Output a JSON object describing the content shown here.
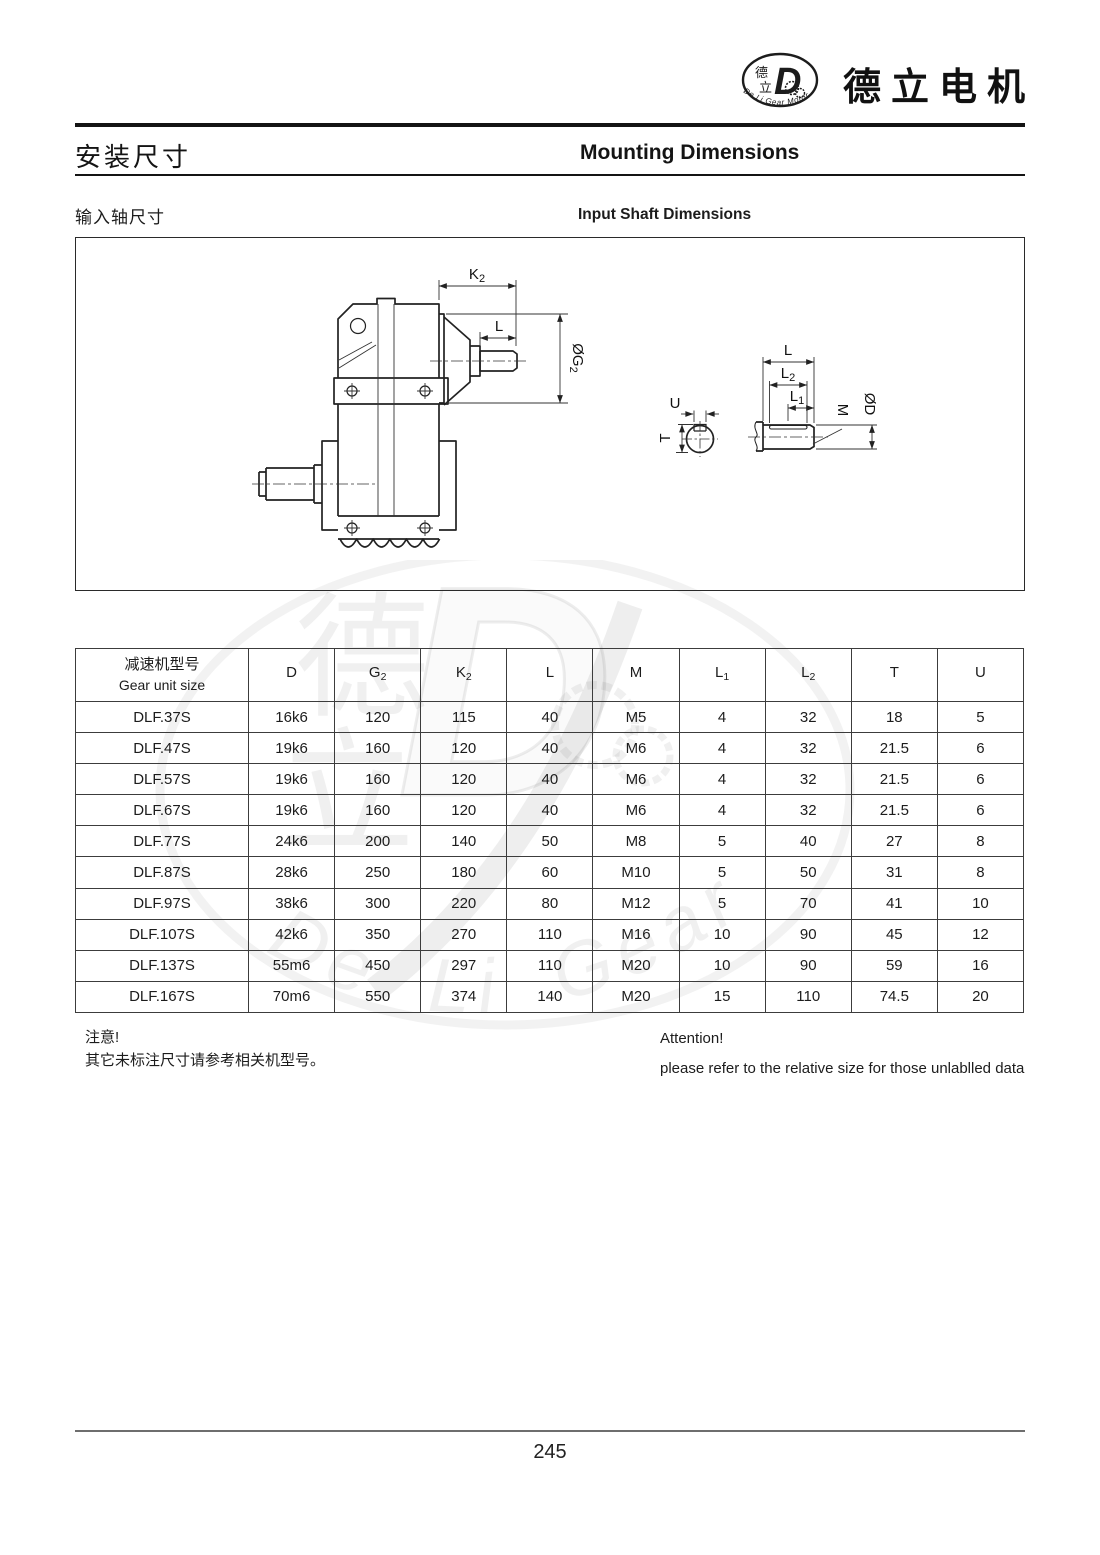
{
  "header": {
    "brand_name": "德立电机",
    "logo": {
      "char_top": "德",
      "char_bottom": "立",
      "monogram": "D",
      "arc_text": "De Li Gear Motor"
    }
  },
  "titles": {
    "main_zh": "安装尺寸",
    "main_en": "Mounting Dimensions",
    "sub_zh": "输入轴尺寸",
    "sub_en": "Input Shaft Dimensions"
  },
  "drawing": {
    "main_view": {
      "dim_k2_main": "K",
      "dim_k2_sub": "2",
      "dim_l": "L",
      "dim_g2_main": "ØG",
      "dim_g2_sub": "2"
    },
    "detail_view": {
      "dim_u": "U",
      "dim_t": "T",
      "dim_l": "L",
      "dim_l2_main": "L",
      "dim_l2_sub": "2",
      "dim_l1_main": "L",
      "dim_l1_sub": "1",
      "dim_m": "M",
      "dim_d": "ØD"
    }
  },
  "table": {
    "header_col1_zh": "减速机型号",
    "header_col1_en": "Gear unit size",
    "headers": [
      {
        "main": "D",
        "sub": ""
      },
      {
        "main": "G",
        "sub": "2"
      },
      {
        "main": "K",
        "sub": "2"
      },
      {
        "main": "L",
        "sub": ""
      },
      {
        "main": "M",
        "sub": ""
      },
      {
        "main": "L",
        "sub": "1"
      },
      {
        "main": "L",
        "sub": "2"
      },
      {
        "main": "T",
        "sub": ""
      },
      {
        "main": "U",
        "sub": ""
      }
    ],
    "rows": [
      {
        "model": "DLF.37S",
        "d": "16k6",
        "g2": "120",
        "k2": "115",
        "l": "40",
        "m": "M5",
        "l1": "4",
        "l2": "32",
        "t": "18",
        "u": "5"
      },
      {
        "model": "DLF.47S",
        "d": "19k6",
        "g2": "160",
        "k2": "120",
        "l": "40",
        "m": "M6",
        "l1": "4",
        "l2": "32",
        "t": "21.5",
        "u": "6"
      },
      {
        "model": "DLF.57S",
        "d": "19k6",
        "g2": "160",
        "k2": "120",
        "l": "40",
        "m": "M6",
        "l1": "4",
        "l2": "32",
        "t": "21.5",
        "u": "6"
      },
      {
        "model": "DLF.67S",
        "d": "19k6",
        "g2": "160",
        "k2": "120",
        "l": "40",
        "m": "M6",
        "l1": "4",
        "l2": "32",
        "t": "21.5",
        "u": "6"
      },
      {
        "model": "DLF.77S",
        "d": "24k6",
        "g2": "200",
        "k2": "140",
        "l": "50",
        "m": "M8",
        "l1": "5",
        "l2": "40",
        "t": "27",
        "u": "8"
      },
      {
        "model": "DLF.87S",
        "d": "28k6",
        "g2": "250",
        "k2": "180",
        "l": "60",
        "m": "M10",
        "l1": "5",
        "l2": "50",
        "t": "31",
        "u": "8"
      },
      {
        "model": "DLF.97S",
        "d": "38k6",
        "g2": "300",
        "k2": "220",
        "l": "80",
        "m": "M12",
        "l1": "5",
        "l2": "70",
        "t": "41",
        "u": "10"
      },
      {
        "model": "DLF.107S",
        "d": "42k6",
        "g2": "350",
        "k2": "270",
        "l": "110",
        "m": "M16",
        "l1": "10",
        "l2": "90",
        "t": "45",
        "u": "12"
      },
      {
        "model": "DLF.137S",
        "d": "55m6",
        "g2": "450",
        "k2": "297",
        "l": "110",
        "m": "M20",
        "l1": "10",
        "l2": "90",
        "t": "59",
        "u": "16"
      },
      {
        "model": "DLF.167S",
        "d": "70m6",
        "g2": "550",
        "k2": "374",
        "l": "140",
        "m": "M20",
        "l1": "15",
        "l2": "110",
        "t": "74.5",
        "u": "20"
      }
    ]
  },
  "notes": {
    "zh_title": "注意!",
    "zh_body": "其它未标注尺寸请参考相关机型号。",
    "en_title": "Attention!",
    "en_body": "please refer to the relative size for those unlablled data"
  },
  "footer": {
    "page_number": "245"
  },
  "watermark": {
    "char_top": "德",
    "char_bottom": "立",
    "monogram": "D",
    "script": "De Li Gear Motor"
  }
}
